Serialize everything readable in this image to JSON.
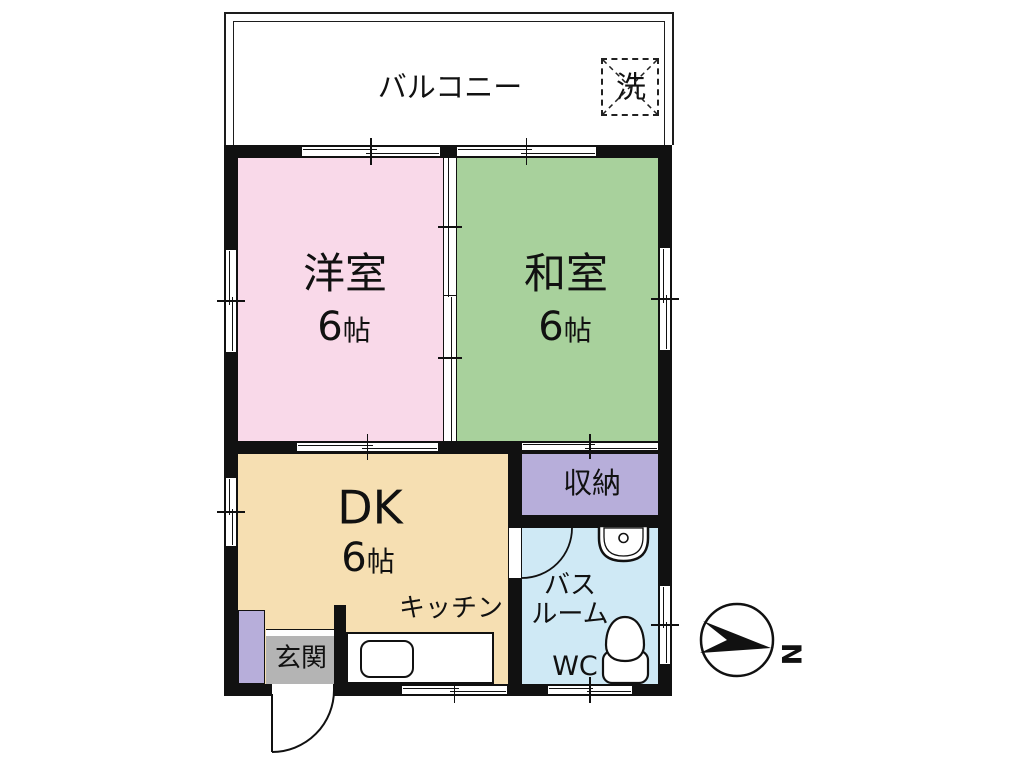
{
  "balcony": {
    "label": "バルコニー",
    "washer_label": "洗"
  },
  "rooms": {
    "western": {
      "name": "洋室",
      "size_num": "6",
      "size_unit": "帖",
      "color": "#f9d9e9"
    },
    "japanese": {
      "name": "和室",
      "size_num": "6",
      "size_unit": "帖",
      "color": "#a8d19c"
    },
    "dk": {
      "name": "DK",
      "size_num": "6",
      "size_unit": "帖",
      "color": "#f6dfb2"
    },
    "kitchen": {
      "label": "キッチン"
    },
    "storage": {
      "name": "収納",
      "color": "#b7aeda"
    },
    "bathroom": {
      "name_line1": "バス",
      "name_line2": "ルーム",
      "wc_label": "WC",
      "color": "#cfe9f5"
    },
    "entrance": {
      "name": "玄関",
      "color": "#b4b4b4",
      "shoebox_color": "#b7aeda"
    }
  },
  "compass": {
    "north_label": "N"
  },
  "colors": {
    "wall": "#111111"
  }
}
